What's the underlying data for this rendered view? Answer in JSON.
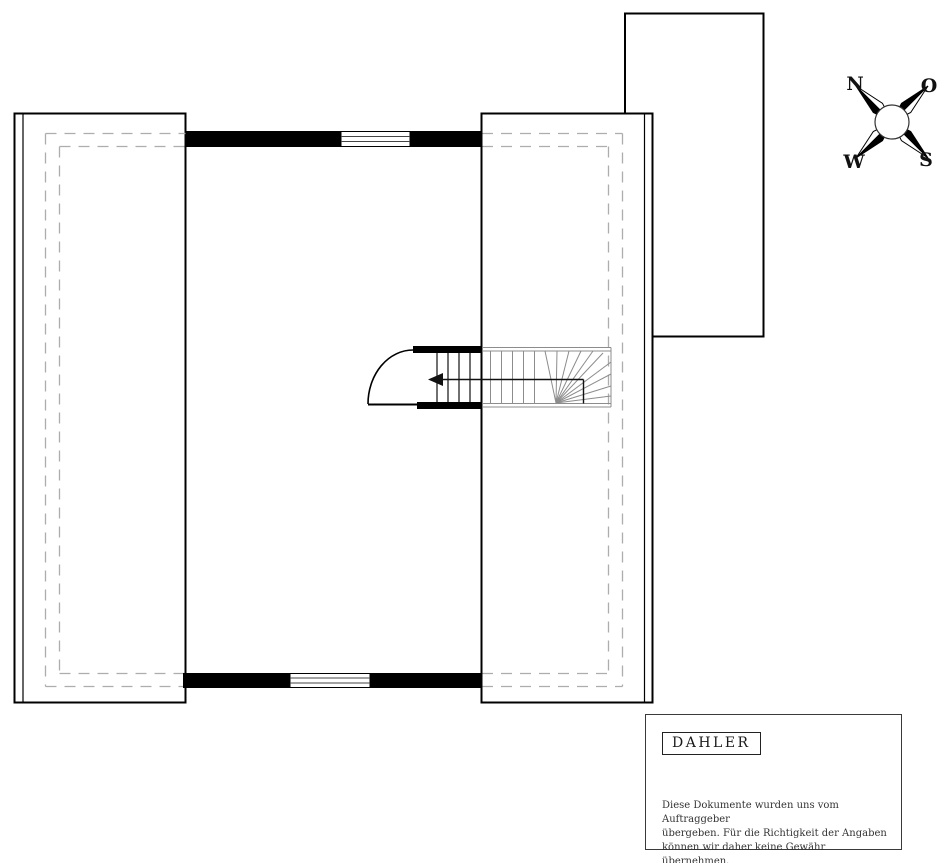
{
  "compass": {
    "north_label": "N",
    "east_label": "O",
    "south_label": "S",
    "west_label": "W"
  },
  "legend": {
    "brand": "DAHLER",
    "disclaimer_lines": [
      "Diese Dokumente wurden uns vom Auftraggeber",
      "übergeben. Für die Richtigkeit der Angaben",
      "können wir daher keine Gewähr übernehmen."
    ]
  },
  "colors": {
    "wall": "#000000",
    "stair_tread": "#8c8c8c",
    "dashed_height_line": "#adadad",
    "background": "#ffffff"
  }
}
